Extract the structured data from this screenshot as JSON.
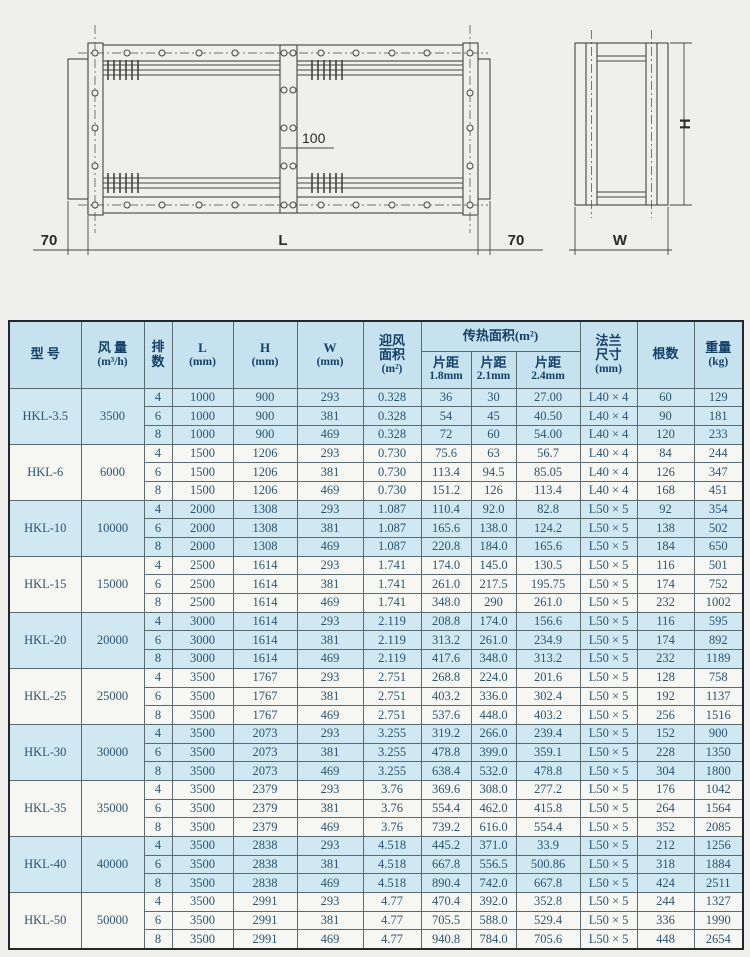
{
  "diagram": {
    "labels": {
      "overhang_left": "70",
      "length": "L",
      "overhang_right": "70",
      "center_offset": "100",
      "height": "H",
      "width": "W"
    }
  },
  "table": {
    "headers": {
      "model": "型 号",
      "air": [
        "风 量",
        "(m³/h)"
      ],
      "row_count": [
        "排",
        "数"
      ],
      "L": [
        "L",
        "(mm)"
      ],
      "H": [
        "H",
        "(mm)"
      ],
      "W": [
        "W",
        "(mm)"
      ],
      "face_area": [
        "迎风",
        "面积",
        "(m²)"
      ],
      "heat_area_group": "传热面积(m²)",
      "pitch_18": [
        "片距",
        "1.8mm"
      ],
      "pitch_21": [
        "片距",
        "2.1mm"
      ],
      "pitch_24": [
        "片距",
        "2.4mm"
      ],
      "flange": [
        "法兰",
        "尺寸",
        "(mm)"
      ],
      "tube_count": "根数",
      "weight": [
        "重量",
        "(kg)"
      ]
    },
    "groups": [
      {
        "model": "HKL-3.5",
        "air": "3500",
        "shaded": true,
        "rows": [
          [
            "4",
            "1000",
            "900",
            "293",
            "0.328",
            "36",
            "30",
            "27.00",
            "L40 × 4",
            "60",
            "129"
          ],
          [
            "6",
            "1000",
            "900",
            "381",
            "0.328",
            "54",
            "45",
            "40.50",
            "L40 × 4",
            "90",
            "181"
          ],
          [
            "8",
            "1000",
            "900",
            "469",
            "0.328",
            "72",
            "60",
            "54.00",
            "L40 × 4",
            "120",
            "233"
          ]
        ]
      },
      {
        "model": "HKL-6",
        "air": "6000",
        "shaded": false,
        "rows": [
          [
            "4",
            "1500",
            "1206",
            "293",
            "0.730",
            "75.6",
            "63",
            "56.7",
            "L40 × 4",
            "84",
            "244"
          ],
          [
            "6",
            "1500",
            "1206",
            "381",
            "0.730",
            "113.4",
            "94.5",
            "85.05",
            "L40 × 4",
            "126",
            "347"
          ],
          [
            "8",
            "1500",
            "1206",
            "469",
            "0.730",
            "151.2",
            "126",
            "113.4",
            "L40 × 4",
            "168",
            "451"
          ]
        ]
      },
      {
        "model": "HKL-10",
        "air": "10000",
        "shaded": true,
        "rows": [
          [
            "4",
            "2000",
            "1308",
            "293",
            "1.087",
            "110.4",
            "92.0",
            "82.8",
            "L50 × 5",
            "92",
            "354"
          ],
          [
            "6",
            "2000",
            "1308",
            "381",
            "1.087",
            "165.6",
            "138.0",
            "124.2",
            "L50 × 5",
            "138",
            "502"
          ],
          [
            "8",
            "2000",
            "1308",
            "469",
            "1.087",
            "220.8",
            "184.0",
            "165.6",
            "L50 × 5",
            "184",
            "650"
          ]
        ]
      },
      {
        "model": "HKL-15",
        "air": "15000",
        "shaded": false,
        "rows": [
          [
            "4",
            "2500",
            "1614",
            "293",
            "1.741",
            "174.0",
            "145.0",
            "130.5",
            "L50 × 5",
            "116",
            "501"
          ],
          [
            "6",
            "2500",
            "1614",
            "381",
            "1.741",
            "261.0",
            "217.5",
            "195.75",
            "L50 × 5",
            "174",
            "752"
          ],
          [
            "8",
            "2500",
            "1614",
            "469",
            "1.741",
            "348.0",
            "290",
            "261.0",
            "L50 × 5",
            "232",
            "1002"
          ]
        ]
      },
      {
        "model": "HKL-20",
        "air": "20000",
        "shaded": true,
        "rows": [
          [
            "4",
            "3000",
            "1614",
            "293",
            "2.119",
            "208.8",
            "174.0",
            "156.6",
            "L50 × 5",
            "116",
            "595"
          ],
          [
            "6",
            "3000",
            "1614",
            "381",
            "2.119",
            "313.2",
            "261.0",
            "234.9",
            "L50 × 5",
            "174",
            "892"
          ],
          [
            "8",
            "3000",
            "1614",
            "469",
            "2.119",
            "417.6",
            "348.0",
            "313.2",
            "L50 × 5",
            "232",
            "1189"
          ]
        ]
      },
      {
        "model": "HKL-25",
        "air": "25000",
        "shaded": false,
        "rows": [
          [
            "4",
            "3500",
            "1767",
            "293",
            "2.751",
            "268.8",
            "224.0",
            "201.6",
            "L50 × 5",
            "128",
            "758"
          ],
          [
            "6",
            "3500",
            "1767",
            "381",
            "2.751",
            "403.2",
            "336.0",
            "302.4",
            "L50 × 5",
            "192",
            "1137"
          ],
          [
            "8",
            "3500",
            "1767",
            "469",
            "2.751",
            "537.6",
            "448.0",
            "403.2",
            "L50 × 5",
            "256",
            "1516"
          ]
        ]
      },
      {
        "model": "HKL-30",
        "air": "30000",
        "shaded": true,
        "rows": [
          [
            "4",
            "3500",
            "2073",
            "293",
            "3.255",
            "319.2",
            "266.0",
            "239.4",
            "L50 × 5",
            "152",
            "900"
          ],
          [
            "6",
            "3500",
            "2073",
            "381",
            "3.255",
            "478.8",
            "399.0",
            "359.1",
            "L50 × 5",
            "228",
            "1350"
          ],
          [
            "8",
            "3500",
            "2073",
            "469",
            "3.255",
            "638.4",
            "532.0",
            "478.8",
            "L50 × 5",
            "304",
            "1800"
          ]
        ]
      },
      {
        "model": "HKL-35",
        "air": "35000",
        "shaded": false,
        "rows": [
          [
            "4",
            "3500",
            "2379",
            "293",
            "3.76",
            "369.6",
            "308.0",
            "277.2",
            "L50 × 5",
            "176",
            "1042"
          ],
          [
            "6",
            "3500",
            "2379",
            "381",
            "3.76",
            "554.4",
            "462.0",
            "415.8",
            "L50 × 5",
            "264",
            "1564"
          ],
          [
            "8",
            "3500",
            "2379",
            "469",
            "3.76",
            "739.2",
            "616.0",
            "554.4",
            "L50 × 5",
            "352",
            "2085"
          ]
        ]
      },
      {
        "model": "HKL-40",
        "air": "40000",
        "shaded": true,
        "rows": [
          [
            "4",
            "3500",
            "2838",
            "293",
            "4.518",
            "445.2",
            "371.0",
            "33.9",
            "L50 × 5",
            "212",
            "1256"
          ],
          [
            "6",
            "3500",
            "2838",
            "381",
            "4.518",
            "667.8",
            "556.5",
            "500.86",
            "L50 × 5",
            "318",
            "1884"
          ],
          [
            "8",
            "3500",
            "2838",
            "469",
            "4.518",
            "890.4",
            "742.0",
            "667.8",
            "L50 × 5",
            "424",
            "2511"
          ]
        ]
      },
      {
        "model": "HKL-50",
        "air": "50000",
        "shaded": false,
        "rows": [
          [
            "4",
            "3500",
            "2991",
            "293",
            "4.77",
            "470.4",
            "392.0",
            "352.8",
            "L50 × 5",
            "244",
            "1327"
          ],
          [
            "6",
            "3500",
            "2991",
            "381",
            "4.77",
            "705.5",
            "588.0",
            "529.4",
            "L50 × 5",
            "336",
            "1990"
          ],
          [
            "8",
            "3500",
            "2991",
            "469",
            "4.77",
            "940.8",
            "784.0",
            "705.6",
            "L50 × 5",
            "448",
            "2654"
          ]
        ]
      }
    ]
  },
  "colors": {
    "band": "#cfe8f2",
    "row_white": "#f6f7f3",
    "header_bg": "#c6e2ee",
    "header_text": "#14406a",
    "data_text": "#2b5570",
    "inner_border": "#5c6b72",
    "outer_border": "#23282c",
    "drawing_line": "#444444",
    "page_bg": "#eff0ee"
  }
}
